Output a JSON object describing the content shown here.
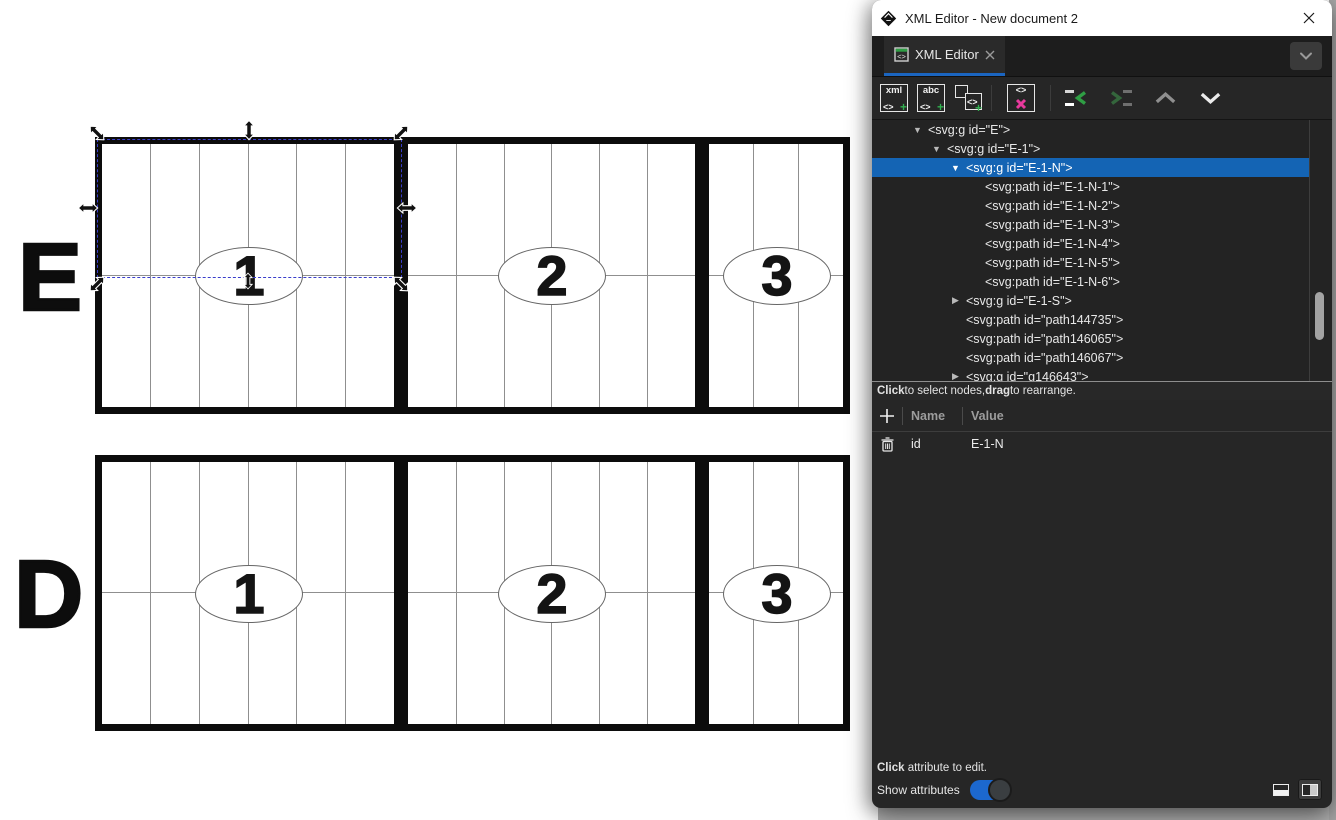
{
  "window": {
    "title": "XML Editor - New document 2",
    "app_icon": "inkscape-logo"
  },
  "tab": {
    "label": "XML Editor"
  },
  "toolbar": {
    "buttons": [
      "new-element-node",
      "new-text-node",
      "duplicate-node",
      "delete-node",
      "unindent-node",
      "indent-node",
      "move-node-up",
      "move-node-down"
    ],
    "glyphs": {
      "xml": "xml",
      "abc": "abc",
      "angle": "<>",
      "plus": "+"
    },
    "disabled": [
      "indent-node",
      "move-node-up"
    ]
  },
  "xml_tree": {
    "rows": [
      {
        "text": "<svg:g id=\"E\">",
        "level": 0,
        "expander": "open",
        "selected": false
      },
      {
        "text": "<svg:g id=\"E-1\">",
        "level": 1,
        "expander": "open",
        "selected": false
      },
      {
        "text": "<svg:g id=\"E-1-N\">",
        "level": 2,
        "expander": "open",
        "selected": true
      },
      {
        "text": "<svg:path id=\"E-1-N-1\">",
        "level": 3,
        "expander": "none",
        "selected": false
      },
      {
        "text": "<svg:path id=\"E-1-N-2\">",
        "level": 3,
        "expander": "none",
        "selected": false
      },
      {
        "text": "<svg:path id=\"E-1-N-3\">",
        "level": 3,
        "expander": "none",
        "selected": false
      },
      {
        "text": "<svg:path id=\"E-1-N-4\">",
        "level": 3,
        "expander": "none",
        "selected": false
      },
      {
        "text": "<svg:path id=\"E-1-N-5\">",
        "level": 3,
        "expander": "none",
        "selected": false
      },
      {
        "text": "<svg:path id=\"E-1-N-6\">",
        "level": 3,
        "expander": "none",
        "selected": false
      },
      {
        "text": "<svg:g id=\"E-1-S\">",
        "level": 2,
        "expander": "closed",
        "selected": false
      },
      {
        "text": "<svg:path id=\"path144735\">",
        "level": 2,
        "expander": "none",
        "selected": false
      },
      {
        "text": "<svg:path id=\"path146065\">",
        "level": 2,
        "expander": "none",
        "selected": false
      },
      {
        "text": "<svg:path id=\"path146067\">",
        "level": 2,
        "expander": "none",
        "selected": false
      },
      {
        "text": "<svg:g id=\"g146643\">",
        "level": 2,
        "expander": "closed",
        "selected": false
      }
    ],
    "expander_open": "▼",
    "expander_closed": "▶",
    "hint": {
      "bold1": "Click",
      "text1": " to select nodes, ",
      "bold2": "drag",
      "text2": " to rearrange."
    }
  },
  "attributes": {
    "columns": {
      "name": "Name",
      "value": "Value"
    },
    "rows": [
      {
        "name": "id",
        "value": "E-1-N"
      }
    ],
    "hint": {
      "bold1": "Click",
      "text1": " attribute to edit."
    },
    "show_label": "Show attributes",
    "toggle_on": true
  },
  "canvas": {
    "rows": [
      {
        "label": "E",
        "sections": [
          {
            "number": "1"
          },
          {
            "number": "2"
          },
          {
            "number": "3"
          }
        ]
      },
      {
        "label": "D",
        "sections": [
          {
            "number": "1"
          },
          {
            "number": "2"
          },
          {
            "number": "3"
          }
        ]
      }
    ],
    "selection": {
      "target": "E-1-N",
      "handles": [
        "nw",
        "n",
        "ne",
        "w",
        "e",
        "sw",
        "s",
        "se"
      ]
    }
  },
  "colors": {
    "tab_accent_blue": "#1b65c0",
    "tree_selection_blue": "#1464b4",
    "toggle_blue": "#1c68cf",
    "delete_pink": "#e8399d",
    "node_green": "#31b04f",
    "selection_dash_blue": "#3a3ecb",
    "titlebar_bg": "#ffffff",
    "panel_bg": "#262626"
  }
}
